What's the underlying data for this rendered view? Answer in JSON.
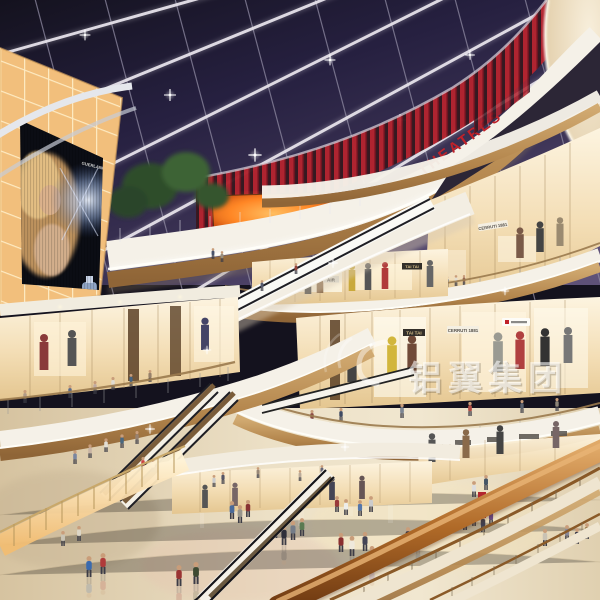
{
  "scene": {
    "type": "architectural-rendering",
    "setting": "multi-level shopping mall atrium with night skylight, curved balconies, escalators and shoppers",
    "watermark": {
      "logo": "swirl",
      "text": "铝翼集团"
    },
    "signs": {
      "theatres": "THEATRES",
      "tai_tai": "TAI TAI",
      "cerruti": "CERRUTI 1881",
      "air": "AIR",
      "billboard_brand": "GUERLAIN"
    },
    "colors": {
      "sky": "#1c1930",
      "sky-light": "#5e5178",
      "mullion": "#e6e2ea",
      "accent-red": "#c0222a",
      "slat-red": "#b3242f",
      "wood": "#b3854c",
      "cream": "#efe5d0",
      "white-band": "#f5f1e8",
      "floor": "#ece0c6",
      "glow-amber": "#f7cf8e",
      "rail-wood": "#b06a28",
      "screen-fire": "#ff7d1f"
    }
  }
}
